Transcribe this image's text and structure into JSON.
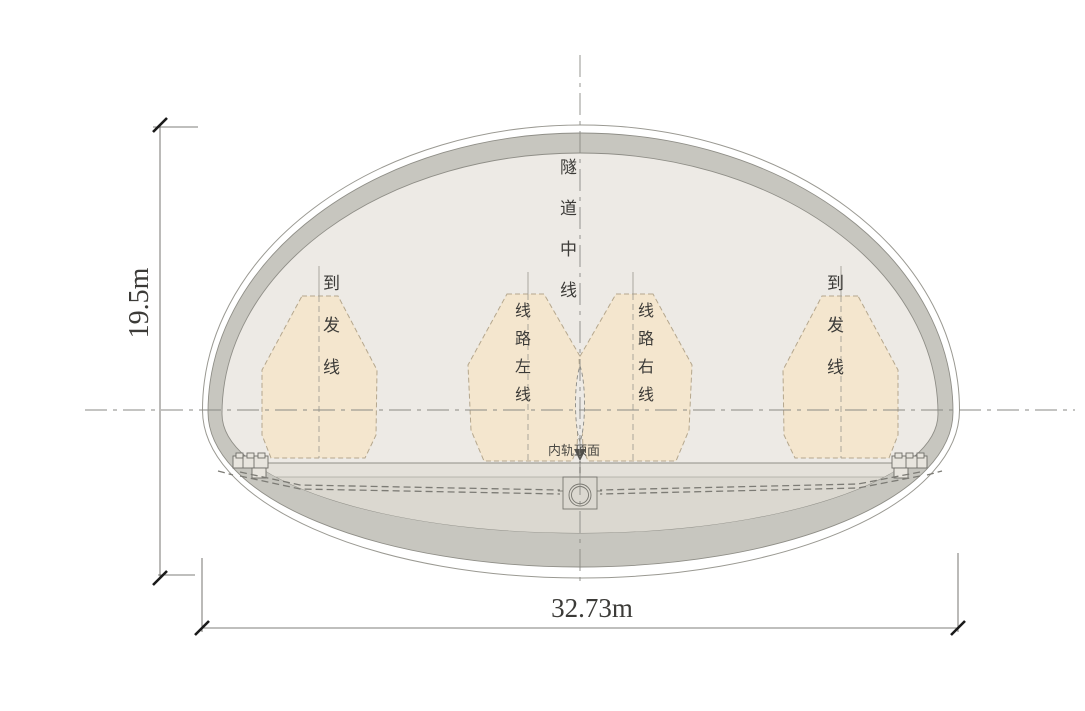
{
  "diagram": {
    "type": "tunnel-cross-section",
    "labels": {
      "tunnel_centerline": "隧道中线",
      "left_arrival_departure": "到发线",
      "route_left_line": "线路左线",
      "route_right_line": "线路右线",
      "right_arrival_departure": "到发线",
      "inner_rail_top_surface": "内轨顶面"
    },
    "dimensions": {
      "height_label": "19.5m",
      "width_label": "32.73m"
    },
    "colors": {
      "envelope_fill": "#f4e6ce",
      "envelope_outline": "#b5a78d",
      "lining_band": "#c7c6bf",
      "inner_wall": "#edeae5",
      "invert_fill": "#dbd8d0",
      "slab_fill": "#e4e1da",
      "outline_gray": "#8f8e87",
      "centerline_gray": "#8a8a84",
      "dimension_line": "#55544f",
      "text_color": "#3c3b38"
    }
  }
}
